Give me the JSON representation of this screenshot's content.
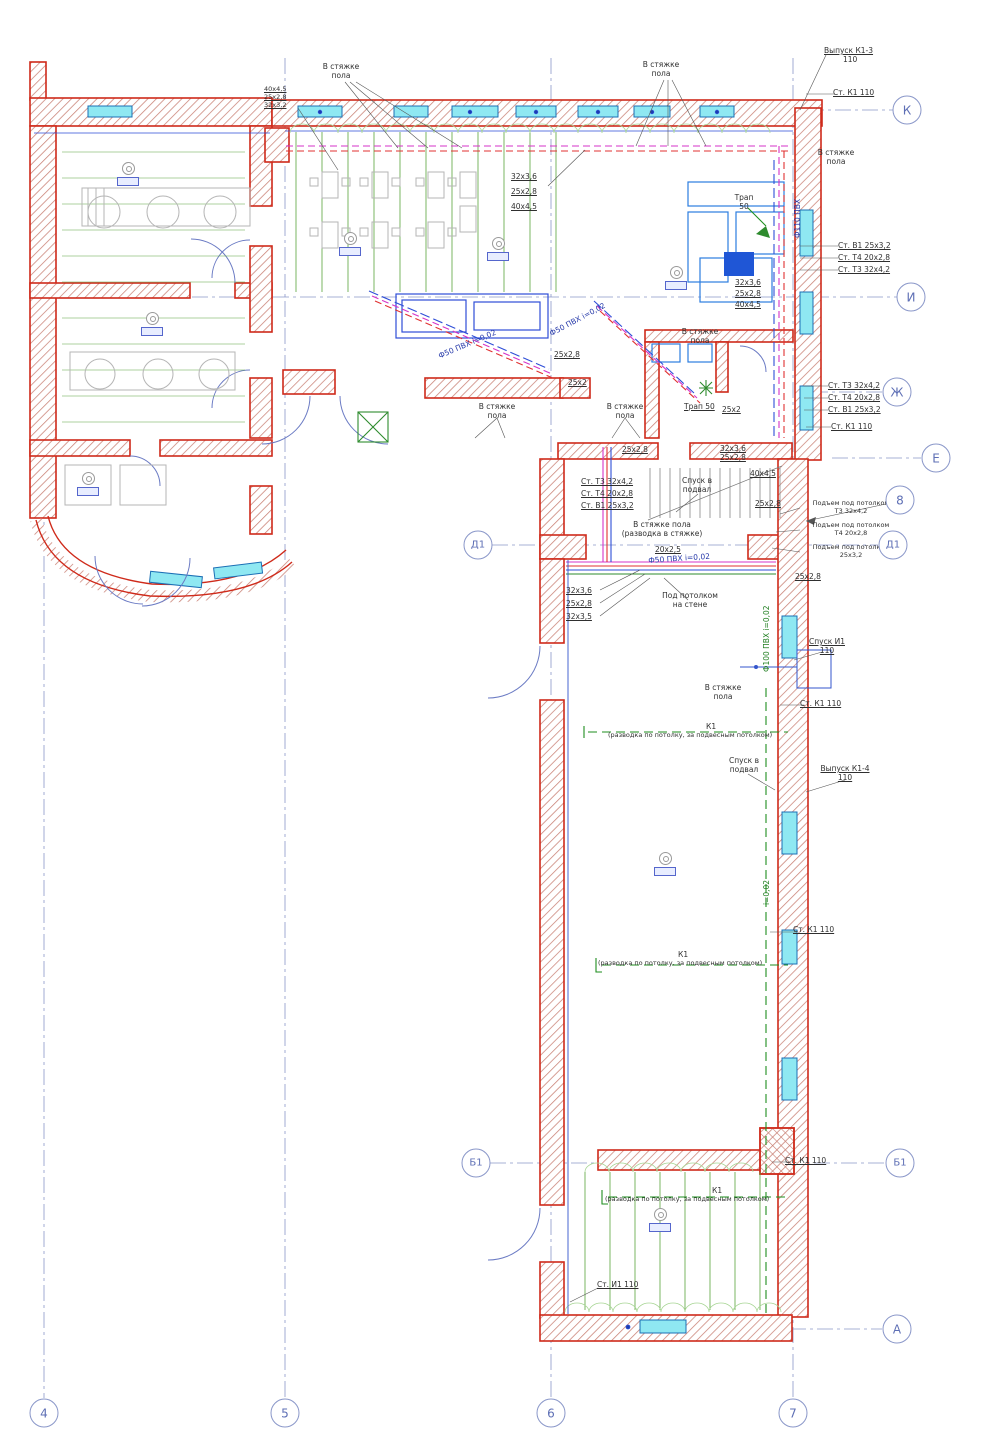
{
  "drawing": {
    "kind": "floor-plan",
    "language": "ru"
  },
  "colors": {
    "walls": "#cf2a1a",
    "windows": "#8fe8f2",
    "heating_supply_T3": "#d633c8",
    "heating_return_T4": "#e03131",
    "cold_water_B1": "#2e4ed7",
    "sewerage_K1": "#1e8e1e",
    "floor_loops": "#5aa53c",
    "axis": "#8a97c9"
  },
  "axes": {
    "rows": [
      {
        "label": "К",
        "x": 907,
        "y": 110
      },
      {
        "label": "И",
        "x": 911,
        "y": 297
      },
      {
        "label": "Ж",
        "x": 897,
        "y": 392
      },
      {
        "label": "Е",
        "x": 936,
        "y": 458
      },
      {
        "label": "8",
        "x": 900,
        "y": 500
      },
      {
        "label": "Д1",
        "x": 893,
        "y": 545
      },
      {
        "label": "Д1",
        "x": 478,
        "y": 545
      },
      {
        "label": "Б1",
        "x": 900,
        "y": 1163
      },
      {
        "label": "Б1",
        "x": 476,
        "y": 1163
      },
      {
        "label": "А",
        "x": 897,
        "y": 1329
      }
    ],
    "columns": [
      {
        "label": "4",
        "x": 44,
        "y": 1413
      },
      {
        "label": "5",
        "x": 285,
        "y": 1413
      },
      {
        "label": "6",
        "x": 551,
        "y": 1413
      },
      {
        "label": "7",
        "x": 793,
        "y": 1413
      }
    ]
  },
  "room_tags": [
    {
      "x": 128,
      "y": 162
    },
    {
      "x": 152,
      "y": 312
    },
    {
      "x": 350,
      "y": 232
    },
    {
      "x": 498,
      "y": 237
    },
    {
      "x": 676,
      "y": 266
    },
    {
      "x": 88,
      "y": 472
    },
    {
      "x": 665,
      "y": 852
    },
    {
      "x": 660,
      "y": 1208
    }
  ],
  "annotations": [
    {
      "t": "Выпуск К1-3",
      "x": 824,
      "y": 46,
      "u": 1
    },
    {
      "t": "110",
      "x": 843,
      "y": 55
    },
    {
      "t": "Ст. К1  110",
      "x": 833,
      "y": 88,
      "u": 1
    },
    {
      "t": "В стяжке\nпола",
      "x": 341,
      "y": 62,
      "c": 1
    },
    {
      "t": "40х4,5",
      "x": 264,
      "y": 86,
      "u": 1,
      "s": 1
    },
    {
      "t": "25х2,8",
      "x": 264,
      "y": 94,
      "u": 1,
      "s": 1
    },
    {
      "t": "32х3,2",
      "x": 264,
      "y": 102,
      "u": 1,
      "s": 1
    },
    {
      "t": "В стяжке\nпола",
      "x": 661,
      "y": 60,
      "c": 1
    },
    {
      "t": "В стяжке\nпола",
      "x": 836,
      "y": 148,
      "c": 1
    },
    {
      "t": "32х3,6",
      "x": 511,
      "y": 172,
      "u": 1
    },
    {
      "t": "25х2,8",
      "x": 511,
      "y": 187,
      "u": 1
    },
    {
      "t": "40х4,5",
      "x": 511,
      "y": 202,
      "u": 1
    },
    {
      "t": "Трап\n50",
      "x": 744,
      "y": 193,
      "c": 1
    },
    {
      "t": "Ст. В1  25х3,2",
      "x": 838,
      "y": 241,
      "u": 1
    },
    {
      "t": "Ст. Т4  20х2,8",
      "x": 838,
      "y": 253,
      "u": 1
    },
    {
      "t": "Ст. Т3  32х4,2",
      "x": 838,
      "y": 265,
      "u": 1
    },
    {
      "t": "32х3,6",
      "x": 735,
      "y": 278,
      "u": 1
    },
    {
      "t": "25х2,8",
      "x": 735,
      "y": 289,
      "u": 1
    },
    {
      "t": "40х4,5",
      "x": 735,
      "y": 300,
      "u": 1
    },
    {
      "t": "Ф50 ПВХ i=0,02",
      "x": 437,
      "y": 352,
      "b": 1,
      "r": -23
    },
    {
      "t": "Ф50 ПВХ i=0,02",
      "x": 548,
      "y": 330,
      "b": 1,
      "r": -28
    },
    {
      "t": "25х2,8",
      "x": 554,
      "y": 350,
      "u": 1
    },
    {
      "t": "25х2",
      "x": 568,
      "y": 378,
      "u": 1
    },
    {
      "t": "В стяжке\nпола",
      "x": 497,
      "y": 402,
      "c": 1
    },
    {
      "t": "В стяжке\nпола",
      "x": 625,
      "y": 402,
      "c": 1
    },
    {
      "t": "В стяжке\nпола",
      "x": 700,
      "y": 327,
      "c": 1
    },
    {
      "t": "Трап 50",
      "x": 684,
      "y": 402,
      "u": 1
    },
    {
      "t": "25х2",
      "x": 722,
      "y": 405,
      "u": 1
    },
    {
      "t": "Ст. Т3  32х4,2",
      "x": 828,
      "y": 381,
      "u": 1
    },
    {
      "t": "Ст. Т4  20х2,8",
      "x": 828,
      "y": 393,
      "u": 1
    },
    {
      "t": "Ст. В1  25х3,2",
      "x": 828,
      "y": 405,
      "u": 1
    },
    {
      "t": "Ст. К1  110",
      "x": 831,
      "y": 422,
      "u": 1
    },
    {
      "t": "25х2,8",
      "x": 622,
      "y": 445,
      "u": 1
    },
    {
      "t": "32х3,6",
      "x": 720,
      "y": 444,
      "u": 1
    },
    {
      "t": "25х2,8",
      "x": 720,
      "y": 453,
      "u": 1
    },
    {
      "t": "Ст. Т3  32х4,2",
      "x": 581,
      "y": 477,
      "u": 1
    },
    {
      "t": "Ст. Т4  20х2,8",
      "x": 581,
      "y": 489,
      "u": 1
    },
    {
      "t": "Ст. В1  25х3,2",
      "x": 581,
      "y": 501,
      "u": 1
    },
    {
      "t": "Спуск в\nподвал",
      "x": 697,
      "y": 476,
      "c": 1
    },
    {
      "t": "40х4,5",
      "x": 750,
      "y": 469,
      "u": 1
    },
    {
      "t": "25х2,8",
      "x": 755,
      "y": 499,
      "u": 1
    },
    {
      "t": "В стяжке пола\n(разводка в стяжке)",
      "x": 662,
      "y": 520,
      "c": 1
    },
    {
      "t": "20х2,5",
      "x": 655,
      "y": 545,
      "u": 1
    },
    {
      "t": "Подъем под потолком\nТ3   32х4,2",
      "x": 851,
      "y": 500,
      "c": 1,
      "s": 1
    },
    {
      "t": "Подъем под потолком\nТ4   20х2,8",
      "x": 851,
      "y": 522,
      "c": 1,
      "s": 1
    },
    {
      "t": "Подъем под потолком\n25х3,2",
      "x": 851,
      "y": 544,
      "c": 1,
      "s": 1
    },
    {
      "t": "Ф50 ПВХ i=0,02",
      "x": 648,
      "y": 556,
      "b": 1,
      "r": -4
    },
    {
      "t": "25х2,8",
      "x": 795,
      "y": 572,
      "u": 1
    },
    {
      "t": "32х3,6",
      "x": 566,
      "y": 586,
      "u": 1
    },
    {
      "t": "25х2,8",
      "x": 566,
      "y": 599,
      "u": 1
    },
    {
      "t": "32х3,5",
      "x": 566,
      "y": 612,
      "u": 1
    },
    {
      "t": "Под потолком\nна стене",
      "x": 690,
      "y": 591,
      "c": 1
    },
    {
      "t": "Спуск И1\n110",
      "x": 827,
      "y": 637,
      "c": 1,
      "u": 1
    },
    {
      "t": "В стяжке\nпола",
      "x": 723,
      "y": 683,
      "c": 1
    },
    {
      "t": "Ст. К1  110",
      "x": 800,
      "y": 699,
      "u": 1
    },
    {
      "t": "К1",
      "x": 706,
      "y": 722
    },
    {
      "t": "(разводка по потолку, за подвесным потолком)",
      "x": 608,
      "y": 732,
      "s": 1
    },
    {
      "t": "Спуск в\nподвал",
      "x": 744,
      "y": 756,
      "c": 1
    },
    {
      "t": "Выпуск К1-4\n110",
      "x": 845,
      "y": 764,
      "c": 1,
      "u": 1
    },
    {
      "t": "Ф100 ПВХ i=0,02",
      "x": 762,
      "y": 672,
      "g": 1,
      "r": -90
    },
    {
      "t": "i=0,02",
      "x": 762,
      "y": 905,
      "g": 1,
      "r": -90
    },
    {
      "t": "Ст. К1  110",
      "x": 793,
      "y": 925,
      "u": 1
    },
    {
      "t": "К1",
      "x": 678,
      "y": 950
    },
    {
      "t": "(разводка по потолку, за подвесным потолком)",
      "x": 598,
      "y": 960,
      "s": 1
    },
    {
      "t": "Ст. К1  110",
      "x": 785,
      "y": 1156,
      "u": 1
    },
    {
      "t": "К1",
      "x": 712,
      "y": 1186
    },
    {
      "t": "(разводка по потолку, за подвесным потолком)",
      "x": 605,
      "y": 1196,
      "s": 1
    },
    {
      "t": "Ст. И1  110",
      "x": 597,
      "y": 1280,
      "u": 1
    },
    {
      "t": "Ф110 ПВХ",
      "x": 793,
      "y": 238,
      "b": 1,
      "r": -90
    }
  ]
}
